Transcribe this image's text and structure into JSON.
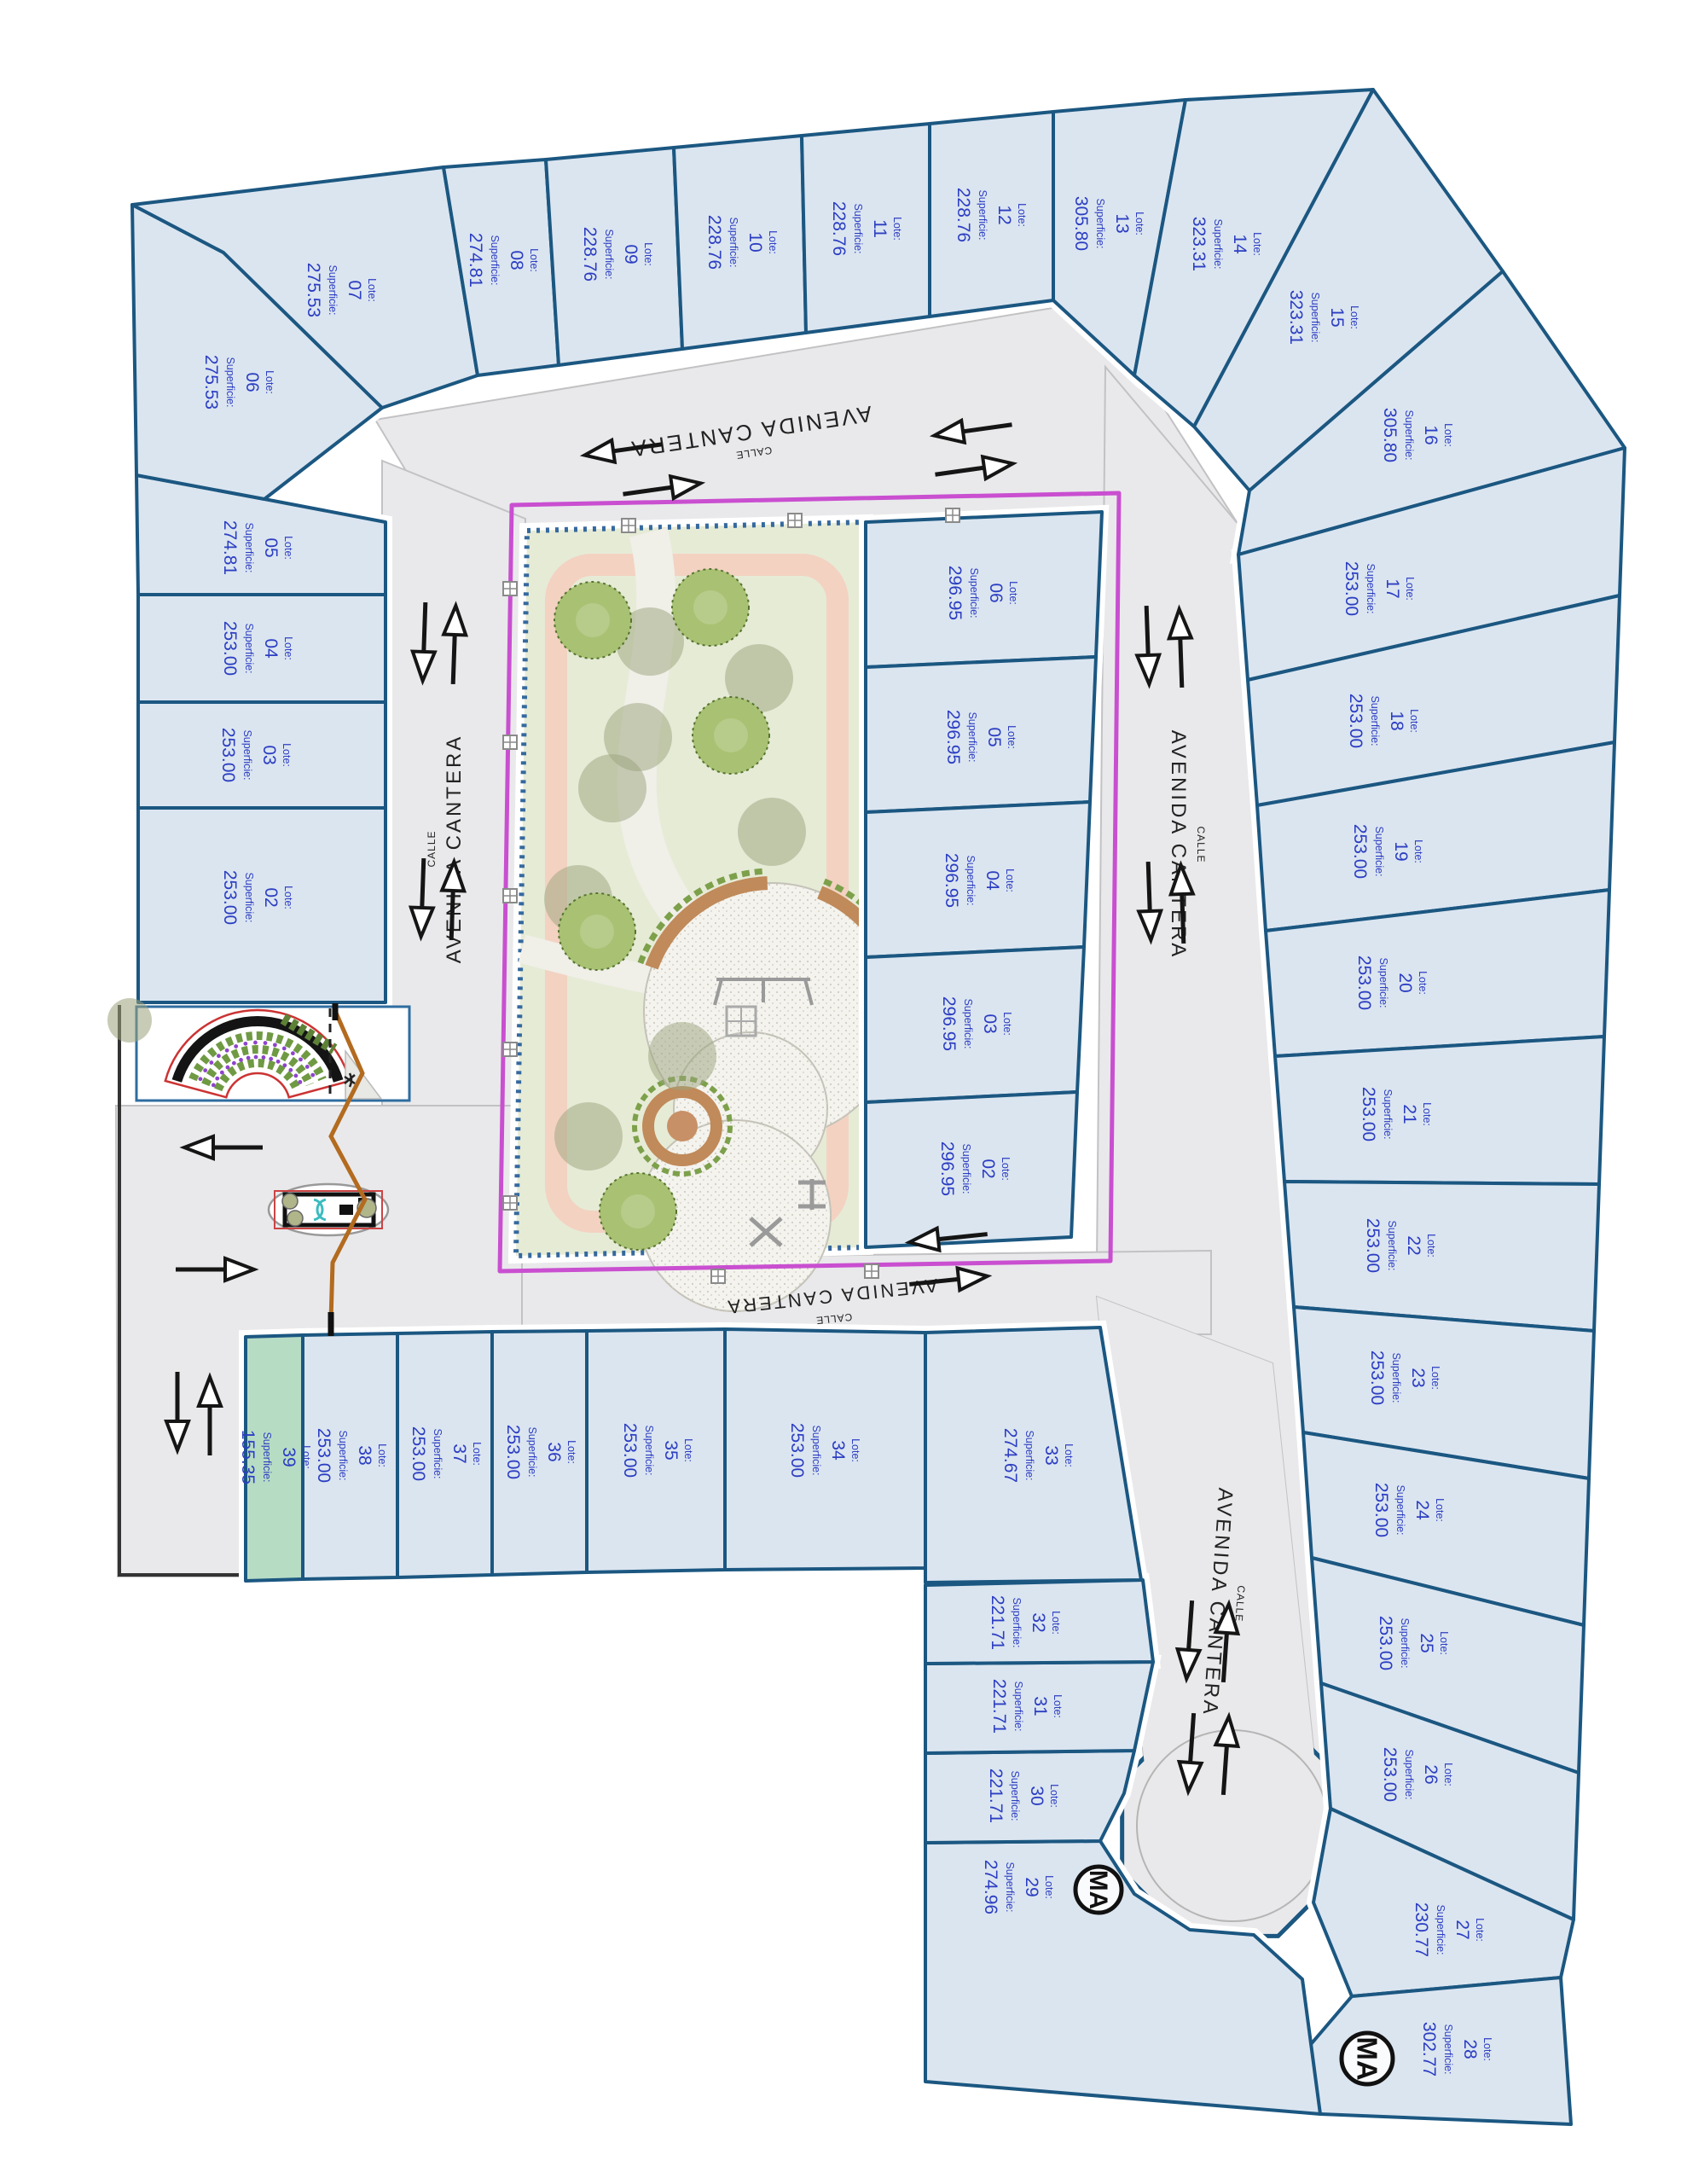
{
  "labels": {
    "lote": "Lote:",
    "superficie": "Superficie:"
  },
  "streets": {
    "prefix": "CALLE",
    "name": "AVENIDA CANTERA"
  },
  "monument_text": "MA",
  "colors": {
    "lot_fill": "#dbe5f0",
    "lot_green_fill": "#b7dcc4",
    "lot_stroke": "#1b5781",
    "label_blue": "#2c3ec2",
    "road_gray": "#e9e9eb",
    "magenta_boundary": "#c94fd0",
    "park_lawn": "#e6ebd6",
    "track_pink": "#f3d2c2",
    "arc_brown": "#c08a5a",
    "gate_orange": "#b36b1f"
  },
  "lots": [
    {
      "id": "o02",
      "n": "02",
      "a": "253.00"
    },
    {
      "id": "o03",
      "n": "03",
      "a": "253.00"
    },
    {
      "id": "o04",
      "n": "04",
      "a": "253.00"
    },
    {
      "id": "o05",
      "n": "05",
      "a": "274.81"
    },
    {
      "id": "o06",
      "n": "06",
      "a": "275.53"
    },
    {
      "id": "o07",
      "n": "07",
      "a": "275.53"
    },
    {
      "id": "o08",
      "n": "08",
      "a": "274.81"
    },
    {
      "id": "o09",
      "n": "09",
      "a": "228.76"
    },
    {
      "id": "o10",
      "n": "10",
      "a": "228.76"
    },
    {
      "id": "o11",
      "n": "11",
      "a": "228.76"
    },
    {
      "id": "o12",
      "n": "12",
      "a": "228.76"
    },
    {
      "id": "o13",
      "n": "13",
      "a": "305.80"
    },
    {
      "id": "o14",
      "n": "14",
      "a": "323.31"
    },
    {
      "id": "o15",
      "n": "15",
      "a": "323.31"
    },
    {
      "id": "o16",
      "n": "16",
      "a": "305.80"
    },
    {
      "id": "o17",
      "n": "17",
      "a": "253.00"
    },
    {
      "id": "o18",
      "n": "18",
      "a": "253.00"
    },
    {
      "id": "o19",
      "n": "19",
      "a": "253.00"
    },
    {
      "id": "o20",
      "n": "20",
      "a": "253.00"
    },
    {
      "id": "o21",
      "n": "21",
      "a": "253.00"
    },
    {
      "id": "o22",
      "n": "22",
      "a": "253.00"
    },
    {
      "id": "o23",
      "n": "23",
      "a": "253.00"
    },
    {
      "id": "o24",
      "n": "24",
      "a": "253.00"
    },
    {
      "id": "o25",
      "n": "25",
      "a": "253.00"
    },
    {
      "id": "o26",
      "n": "26",
      "a": "253.00"
    },
    {
      "id": "o27",
      "n": "27",
      "a": "230.77"
    },
    {
      "id": "o28",
      "n": "28",
      "a": "302.77"
    },
    {
      "id": "o29",
      "n": "29",
      "a": "274.96"
    },
    {
      "id": "o30",
      "n": "30",
      "a": "221.71"
    },
    {
      "id": "o31",
      "n": "31",
      "a": "221.71"
    },
    {
      "id": "o32",
      "n": "32",
      "a": "221.71"
    },
    {
      "id": "o33",
      "n": "33",
      "a": "274.67"
    },
    {
      "id": "o34",
      "n": "34",
      "a": "253.00"
    },
    {
      "id": "o35",
      "n": "35",
      "a": "253.00"
    },
    {
      "id": "o36",
      "n": "36",
      "a": "253.00"
    },
    {
      "id": "o37",
      "n": "37",
      "a": "253.00"
    },
    {
      "id": "o38",
      "n": "38",
      "a": "253.00"
    },
    {
      "id": "o39",
      "n": "39",
      "a": "155.35",
      "green": true
    },
    {
      "id": "i06",
      "n": "06",
      "a": "296.95"
    },
    {
      "id": "i05",
      "n": "05",
      "a": "296.95"
    },
    {
      "id": "i04",
      "n": "04",
      "a": "296.95"
    },
    {
      "id": "i03",
      "n": "03",
      "a": "296.95"
    },
    {
      "id": "i02",
      "n": "02",
      "a": "296.95"
    }
  ]
}
